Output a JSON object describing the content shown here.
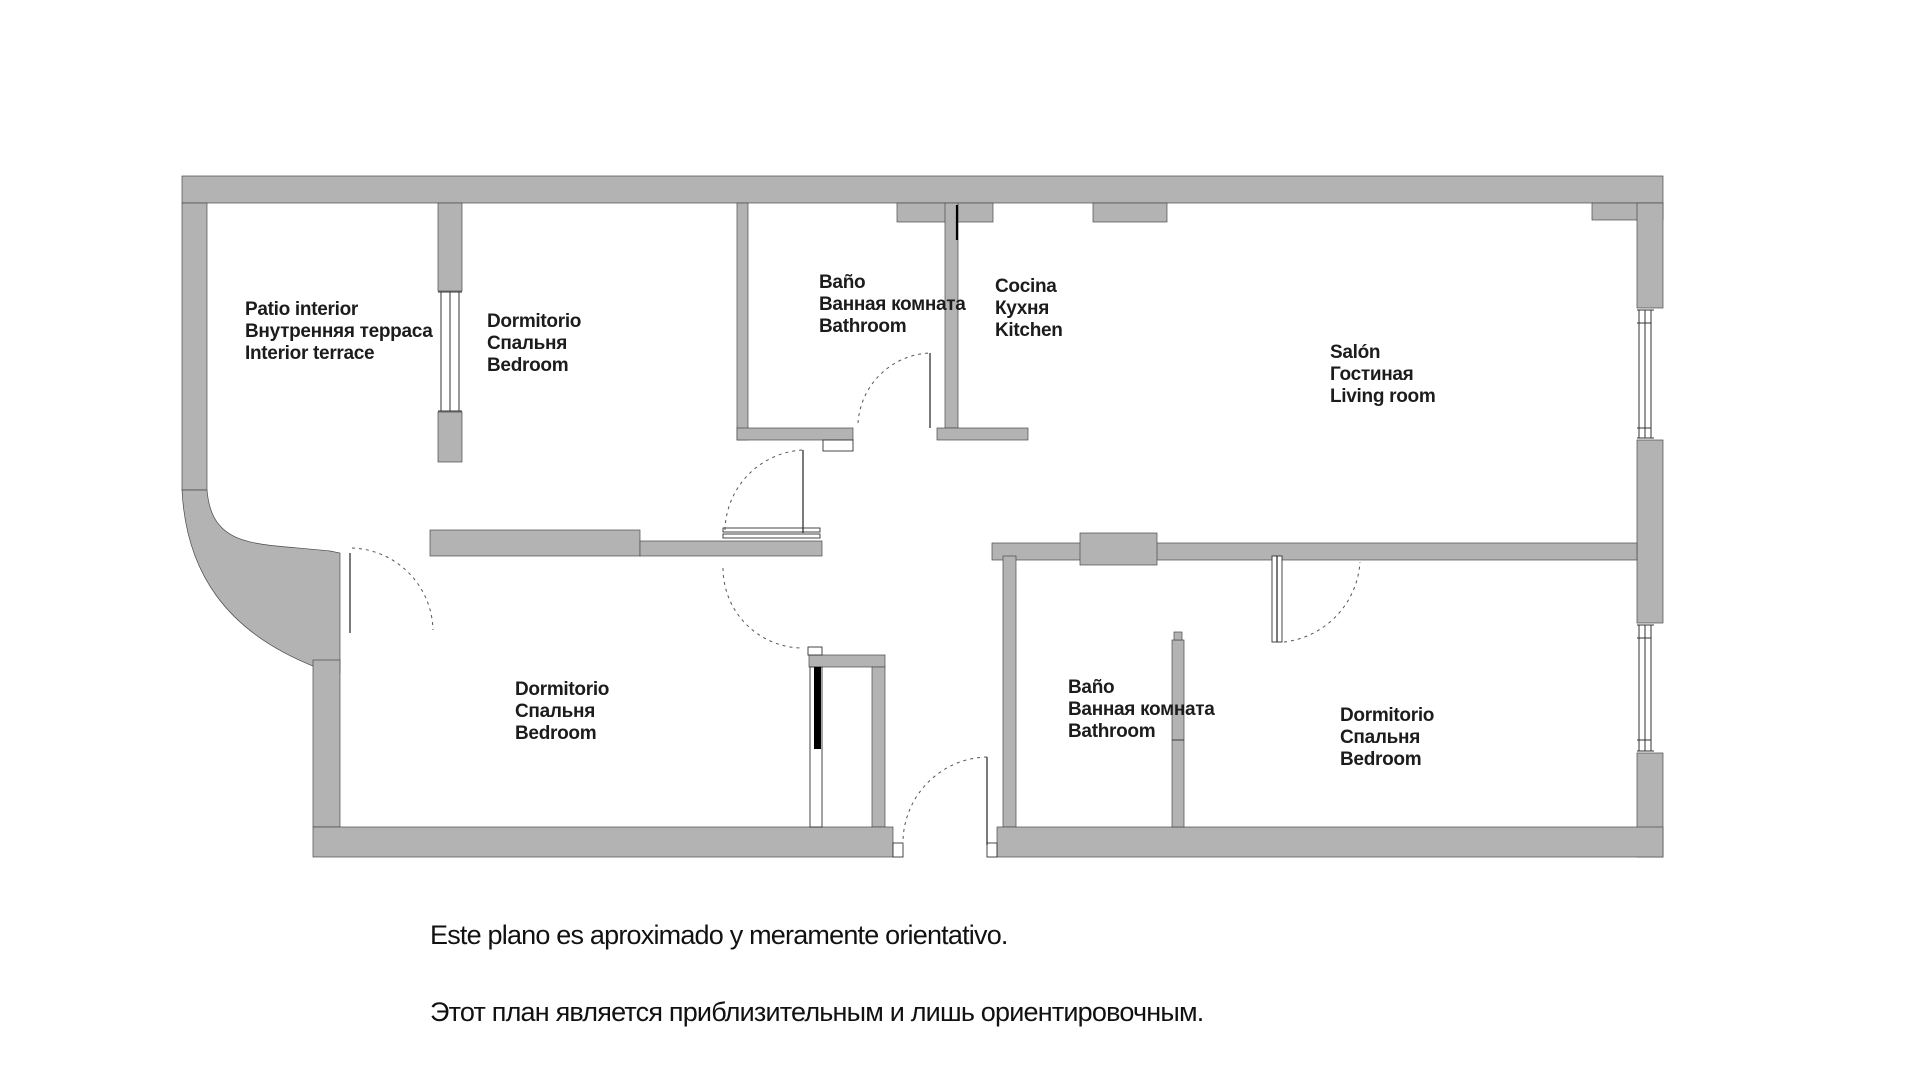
{
  "plan": {
    "title": "Apartment floor plan",
    "wall_color": "#b3b3b3",
    "rooms": [
      {
        "id": "patio",
        "es": "Patio interior",
        "ru": "Внутренняя терраса",
        "en": "Interior terrace"
      },
      {
        "id": "bedroom-top",
        "es": "Dormitorio",
        "ru": "Спальня",
        "en": "Bedroom"
      },
      {
        "id": "bathroom-top",
        "es": "Baño",
        "ru": "Ванная комната",
        "en": "Bathroom"
      },
      {
        "id": "kitchen",
        "es": "Cocina",
        "ru": "Кухня",
        "en": "Kitchen"
      },
      {
        "id": "living-room",
        "es": "Salón",
        "ru": "Гостиная",
        "en": "Living room"
      },
      {
        "id": "bedroom-bottom-left",
        "es": "Dormitorio",
        "ru": "Спальня",
        "en": "Bedroom"
      },
      {
        "id": "bathroom-bottom",
        "es": "Baño",
        "ru": "Ванная комната",
        "en": "Bathroom"
      },
      {
        "id": "bedroom-bottom-right",
        "es": "Dormitorio",
        "ru": "Спальня",
        "en": "Bedroom"
      }
    ],
    "footer": {
      "line1": "Este plano es aproximado y meramente orientativo.",
      "line2": "Этот план является приблизительным и лишь ориентировочным."
    }
  }
}
